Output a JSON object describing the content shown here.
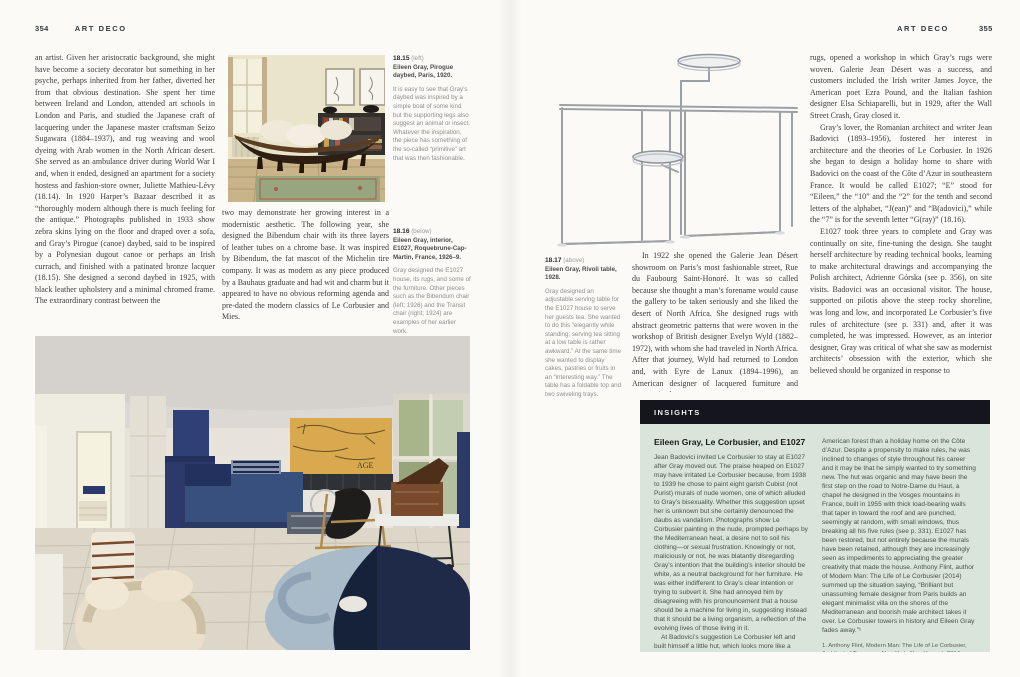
{
  "colors": {
    "page_bg": "#fbfaf7",
    "body_text": "#3c3c3c",
    "caption_gray": "#8e8e8c",
    "insights_header_bg": "#15151d",
    "insights_bg": "#d9e4da",
    "e1027_blue": "#2e4076",
    "chart_yellow": "#d8a94f"
  },
  "left_page": {
    "page_number": "354",
    "header": "ART DECO",
    "column1": "an artist. Given her aristocratic background, she might have become a society decorator but something in her psyche, perhaps inherited from her father, diverted her from that obvious destination. She spent her time between Ireland and London, attended art schools in London and Paris, and studied the Japanese craft of lacquering under the Japanese master craftsman Seizo Sugawara (1884–1937), and rug weaving and wool dyeing with Arab women in the North African desert. She served as an ambulance driver during World War I and, when it ended, designed an apartment for a society hostess and fashion-store owner, Juliette Mathieu-Lévy (18.14). In 1920 Harper’s Bazaar described it as “thoroughly modern although there is much feeling for the antique.” Photographs published in 1933 show zebra skins lying on the floor and draped over a sofa, and Gray’s Pirogue (canoe) daybed, said to be inspired by a Polynesian dugout canoe or perhaps an Irish currach, and finished with a patinated bronze lacquer (18.15). She designed a second daybed in 1925, with black leather upholstery and a minimal chromed frame. The extraordinary contrast between the",
    "column2": "two may demonstrate her growing interest in a modernistic aesthetic. The following year, she designed the Bibendum chair with its three layers of leather tubes on a chrome base. It was inspired by Bibendum, the fat mascot of the Michelin tire company. It was as modern as any piece produced by a Bauhaus graduate and had wit and charm but it appeared to have no obvious reforming agenda and pre-dated the modern classics of Le Corbusier and Mies.",
    "caption_1815": {
      "number": "18.15",
      "placement": "(left)",
      "title": "Eileen Gray, Pirogue daybed, Paris, 1920.",
      "body": "It is easy to see that Gray’s daybed was inspired by a simple boat of some kind but the supporting legs also suggest an animal or insect. Whatever the inspiration, the piece has something of the so-called “primitive” art that was then fashionable."
    },
    "caption_1816": {
      "number": "18.16",
      "placement": "(below)",
      "title": "Eileen Gray, interior, E1027, Roquebrune-Cap-Martin, France, 1926–9.",
      "body": "Gray designed the E1027 house, its rugs, and some of the furniture. Other pieces such as the Bibendum chair (left; 1926) and the Transit chair (right; 1924) are examples of her earlier work."
    }
  },
  "right_page": {
    "page_number": "355",
    "header": "ART DECO",
    "caption_1817": {
      "number": "18.17",
      "placement": "(above)",
      "title": "Eileen Gray, Rivoli table, 1928.",
      "body": "Gray designed an adjustable serving table for the E1027 house to serve her guests tea. She wanted to do this “elegantly while standing; serving tea sitting at a low table is rather awkward.” At the same time she wanted to display cakes, pastries or fruits in an “interesting way.” The table has a foldable top and two swiveling trays."
    },
    "column1": "In 1922 she opened the Galerie Jean Désert showroom on Paris’s most fashionable street, Rue du Faubourg Saint-Honoré. It was so called because she thought a man’s forename would cause the gallery to be taken seriously and she liked the desert of North Africa. She designed rugs with abstract geometric patterns that were woven in the workshop of British designer Evelyn Wyld (1882–1972), with whom she had traveled in North Africa. After that journey, Wyld had returned to London and, with Eyre de Lanux (1894–1996), an American designer of lacquered furniture and geometric abstract",
    "column2": {
      "p1": "rugs, opened a workshop in which Gray’s rugs were woven. Galerie Jean Désert was a success, and customers included the Irish writer James Joyce, the American poet Ezra Pound, and the Italian fashion designer Elsa Schiaparelli, but in 1929, after the Wall Street Crash, Gray closed it.",
      "p2": "Gray’s lover, the Romanian architect and writer Jean Badovici (1893–1956), fostered her interest in architecture and the theories of Le Corbusier. In 1926 she began to design a holiday home to share with Badovici on the coast of the Côte d’Azur in southeastern France. It would be called E1027; “E” stood for “Eileen,” the “10” and the “2” for the tenth and second letters of the alphabet, “J(ean)” and “B(adovici),” while the “7” is for the seventh letter “G(ray)” (18.16).",
      "p3": "E1027 took three years to complete and Gray was continually on site, fine-tuning the design. She taught herself architecture by reading technical books, learning to make architectural drawings and accompanying the Polish architect, Adrienne Górska (see p. 356), on site visits. Badovici was an occasional visitor. The house, supported on pilotis above the steep rocky shoreline, was long and low, and incorporated Le Corbusier’s five rules of architecture (see p. 331) and, after it was completed, he was impressed. However, as an interior designer, Gray was critical of what she saw as modernist architects’ obsession with the exterior, which she believed should be organized in response to"
    },
    "insights": {
      "label": "INSIGHTS",
      "title": "Eileen Gray, Le Corbusier, and E1027",
      "col1_p1": "Jean Badovici invited Le Corbusier to stay at E1027 after Gray moved out. The praise heaped on E1027 may have irritated Le Corbusier because, from 1938 to 1939 he chose to paint eight garish Cubist (not Purist) murals of nude women, one of which alluded to Gray’s bisexuality. Whether this suggestion upset her is unknown but she certainly denounced the daubs as vandalism. Photographs show Le Corbusier painting in the nude, prompted perhaps by the Mediterranean heat, a desire not to soil his clothing—or sexual frustration. Knowingly or not, maliciously or not, he was blatantly disregarding Gray’s intention that the building’s interior should be white, as a neutral background for her furniture. He was either indifferent to Gray’s clear intention or trying to subvert it. She had annoyed him by disagreeing with his pronouncement that a house should be a machine for living in, suggesting instead that it should be a living organism, a reflection of the evolving lives of those living in it.",
      "col1_p2": "At Badovici’s suggestion Le Corbusier left and built himself a little hut, which looks more like a cabin in an",
      "col2": "American forest than a holiday home on the Côte d’Azur. Despite a propensity to make rules, he was inclined to changes of style throughout his career and it may be that he simply wanted to try something new. The hut was organic and may have been the first step on the road to Notre-Dame du Haut, a chapel he designed in the Vosges mountains in France, built in 1955 with thick load-bearing walls that taper in toward the roof and are punched, seemingly at random, with small windows, thus breaking all his five rules (see p. 331). E1027 has been restored, but not entirely because the murals have been retained, although they are increasingly seen as impediments to appreciating the greater creativity that made the house. Anthony Flint, author of Modern Man: The Life of Le Corbusier (2014) summed up the situation saying, “Brilliant but unassuming female designer from Paris builds an elegant minimalist villa on the shores of the Mediterranean and boorish male architect takes it over. Le Corbusier towers in history and Eileen Gray fades away.”¹",
      "footnote": "1. Anthony Flint, Modern Man: The Life of Le Corbusier, Architect of Tomorrow. New York: New Harvest, 2014"
    }
  }
}
